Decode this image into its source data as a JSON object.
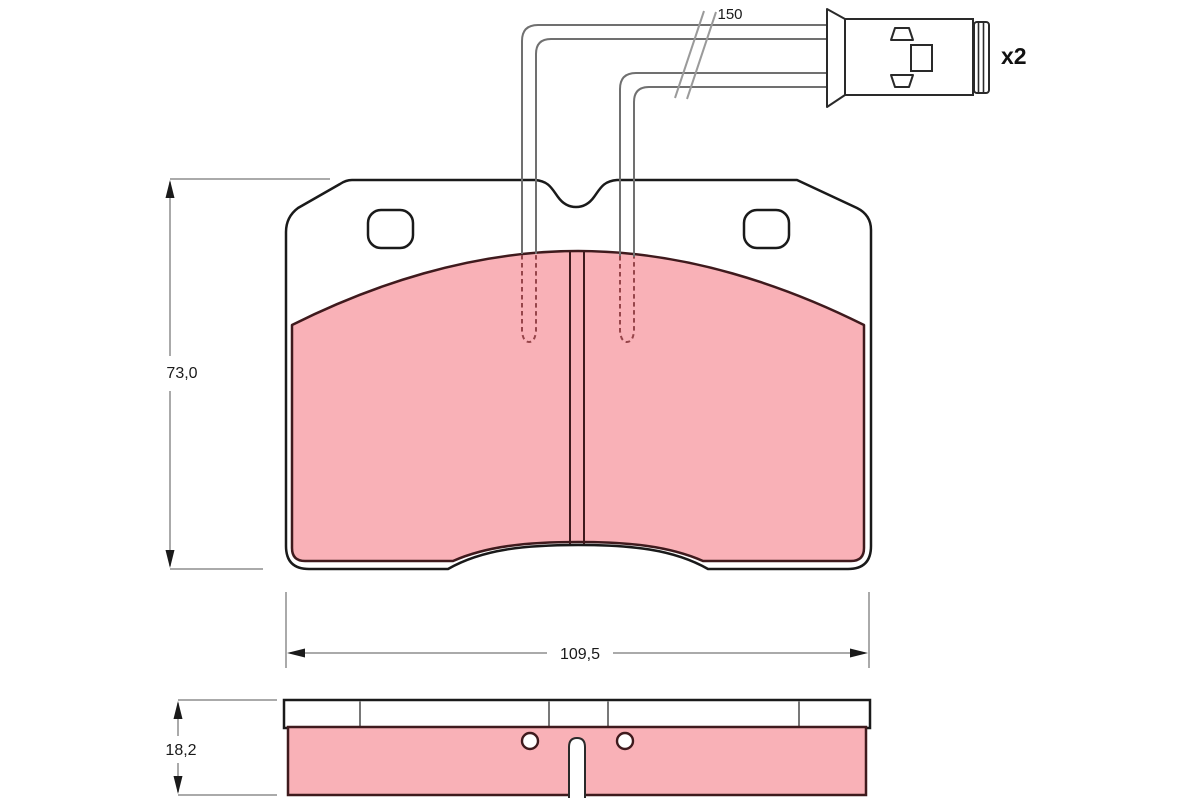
{
  "labels": {
    "pad_height": "73,0",
    "pad_width": "109,5",
    "pad_thickness": "18,2",
    "sensor_wire_length": "150",
    "sensor_quantity": "x2"
  },
  "colors": {
    "background": "#FFFFFF",
    "friction_fill": "#F9B1B7",
    "friction_outline": "#3F1A1D",
    "backplate_outline": "#1A1A1A",
    "dimension_line": "#8E8E8E",
    "dimension_text": "#1A1A1A",
    "wire_line": "#707070",
    "hidden_detail_dashed": "#96454A",
    "connector_outline": "#2A2A2A"
  }
}
